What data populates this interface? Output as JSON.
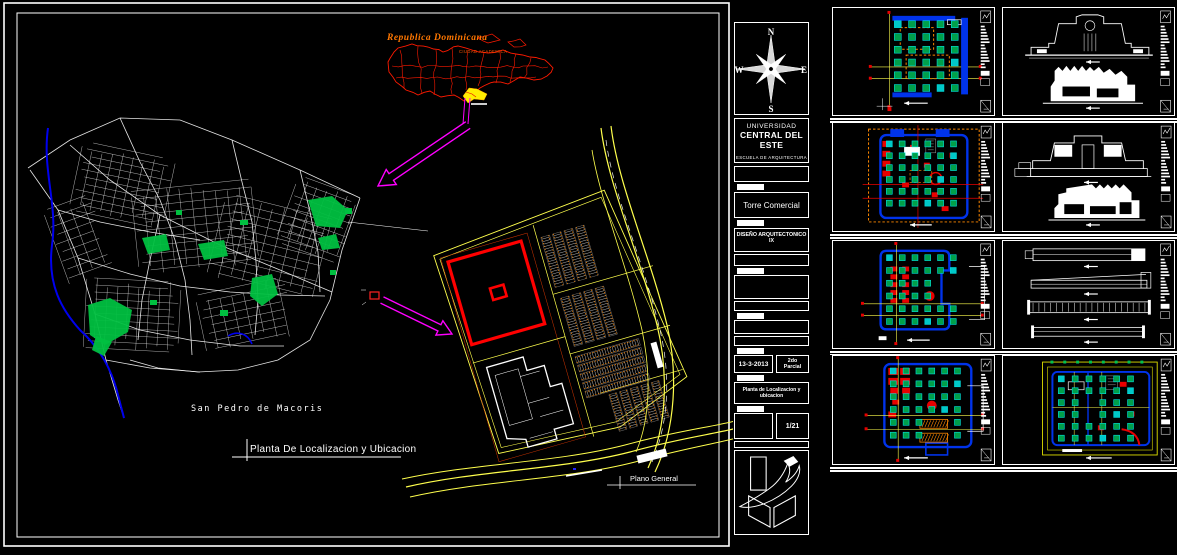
{
  "sheet": {
    "map_title": "Republica Dominicana",
    "map_label": "CIUDAD ACADEMICA",
    "city_label": "San Pedro de Macoris",
    "caption": "Planta De Localizacion y Ubicacion",
    "site_label": "Plano General"
  },
  "title_block": {
    "compass": {
      "n": "N",
      "s": "S",
      "e": "E",
      "w": "W"
    },
    "university_line1": "UNIVERSIDAD",
    "university_line2": "CENTRAL DEL ESTE",
    "school": "ESCUELA DE ARQUITECTURA",
    "project": "Torre Comercial",
    "course_line1": "DISEÑO ARQUITECTONICO",
    "course_line2": "IX",
    "date": "13-3-2013",
    "term_line1": "2do",
    "term_line2": "Parcial",
    "drawing_title_line1": "Planta de Localizacion y",
    "drawing_title_line2": "ubicacion",
    "sheet_number": "1/21"
  },
  "thumbnails": [
    {
      "type": "structural-column-plan"
    },
    {
      "type": "front-elevations"
    },
    {
      "type": "furnished-floor-plan"
    },
    {
      "type": "side-elevations"
    },
    {
      "type": "upper-floor-plan"
    },
    {
      "type": "building-sections"
    },
    {
      "type": "typical-floor-plan"
    },
    {
      "type": "roof-plan"
    }
  ],
  "colors": {
    "red": "#ff0000",
    "yellow": "#ffff4d",
    "magenta": "#ff00ff",
    "cyan": "#00e0e0",
    "green": "#00c050",
    "blue": "#0033eb",
    "orange": "#ff8800",
    "white": "#ffffff",
    "background": "#000000"
  }
}
